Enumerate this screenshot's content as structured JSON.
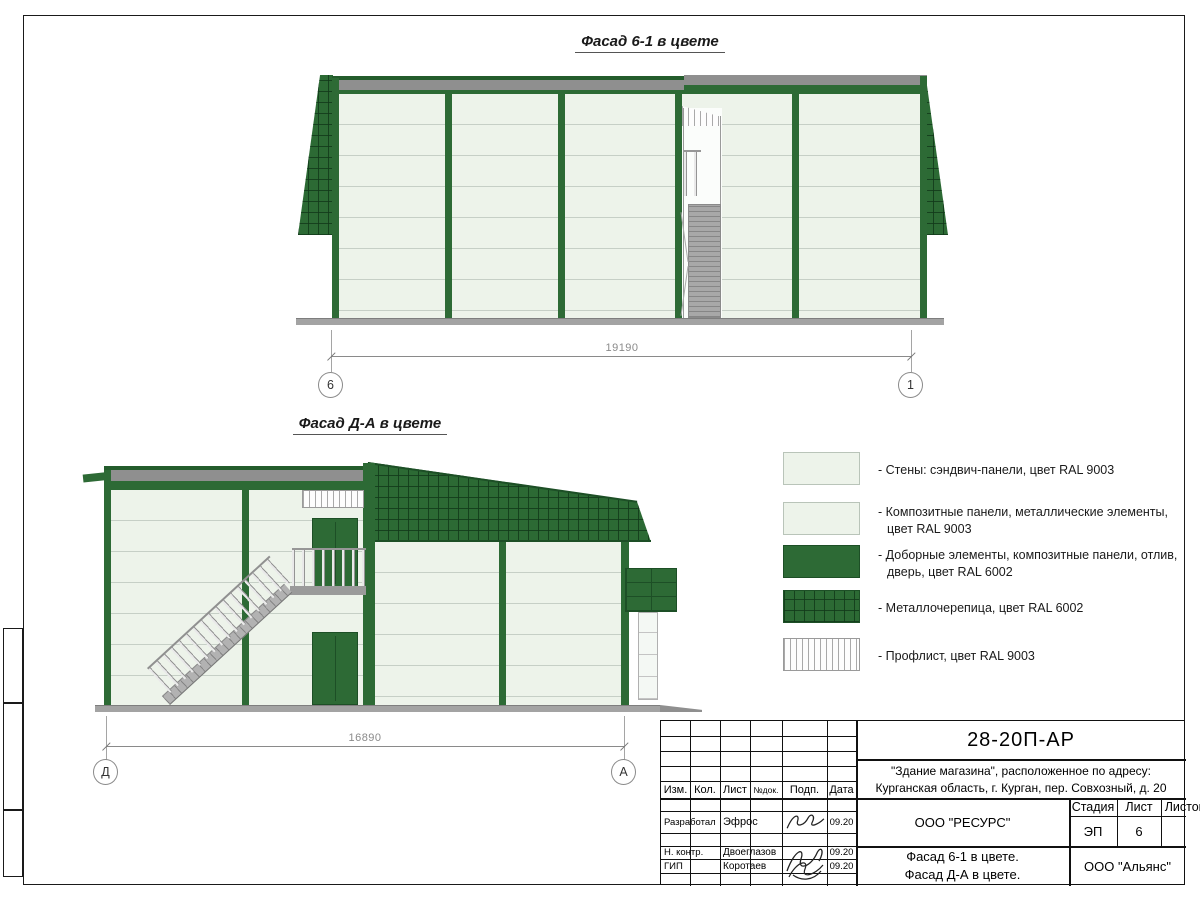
{
  "page": {
    "facade1_title": "Фасад 6-1 в цвете",
    "facade2_title": "Фасад Д-А в цвете"
  },
  "dimensions": {
    "facade1": {
      "value": "19190",
      "axis_left": "6",
      "axis_right": "1"
    },
    "facade2": {
      "value": "16890",
      "axis_left": "Д",
      "axis_right": "А"
    }
  },
  "legend": {
    "items": [
      {
        "swatch": "light-panel",
        "label": "- Стены: сэндвич-панели, цвет RAL 9003"
      },
      {
        "swatch": "light-panel",
        "label": "- Композитные панели, металлические элементы, цвет RAL 9003"
      },
      {
        "swatch": "green-solid",
        "label": "- Доборные элементы,  композитные панели, отлив, дверь, цвет RAL 6002"
      },
      {
        "swatch": "roof-tiles",
        "label": "- Металлочерепица, цвет RAL 6002"
      },
      {
        "swatch": "prof-sheet",
        "label": "- Профлист, цвет RAL 9003"
      }
    ]
  },
  "title_block": {
    "doc_number": "28-20П-АР",
    "project_line1": "\"Здание магазина\", расположенное по адресу:",
    "project_line2": "Курганская область, г. Курган, пер. Совхозный, д. 20",
    "columns": [
      "Изм.",
      "Кол.",
      "Лист",
      "№док.",
      "Подп.",
      "Дата"
    ],
    "rows": [
      {
        "role": "Разработал",
        "name": "Эфрос",
        "date": "09.20"
      },
      {
        "role": "Н. контр.",
        "name": "Двоеглазов",
        "date": "09.20"
      },
      {
        "role": "ГИП",
        "name": "Коротаев",
        "date": "09.20"
      }
    ],
    "org_middle": "ООО \"РЕСУРС\"",
    "sheet_title_line1": "Фасад 6-1 в цвете.",
    "sheet_title_line2": "Фасад Д-А в цвете.",
    "org_bottom": "ООО \"Альянс\"",
    "stage_label": "Стадия",
    "sheet_label": "Лист",
    "sheets_label": "Листов",
    "stage_value": "ЭП",
    "sheet_value": "6"
  },
  "colors": {
    "accent_green": "#2d6a35",
    "dark_green": "#1d4f26",
    "panel_light": "#edf3ea",
    "flashing_gray": "#8f8f8f",
    "ground_gray": "#a3a3a3"
  }
}
